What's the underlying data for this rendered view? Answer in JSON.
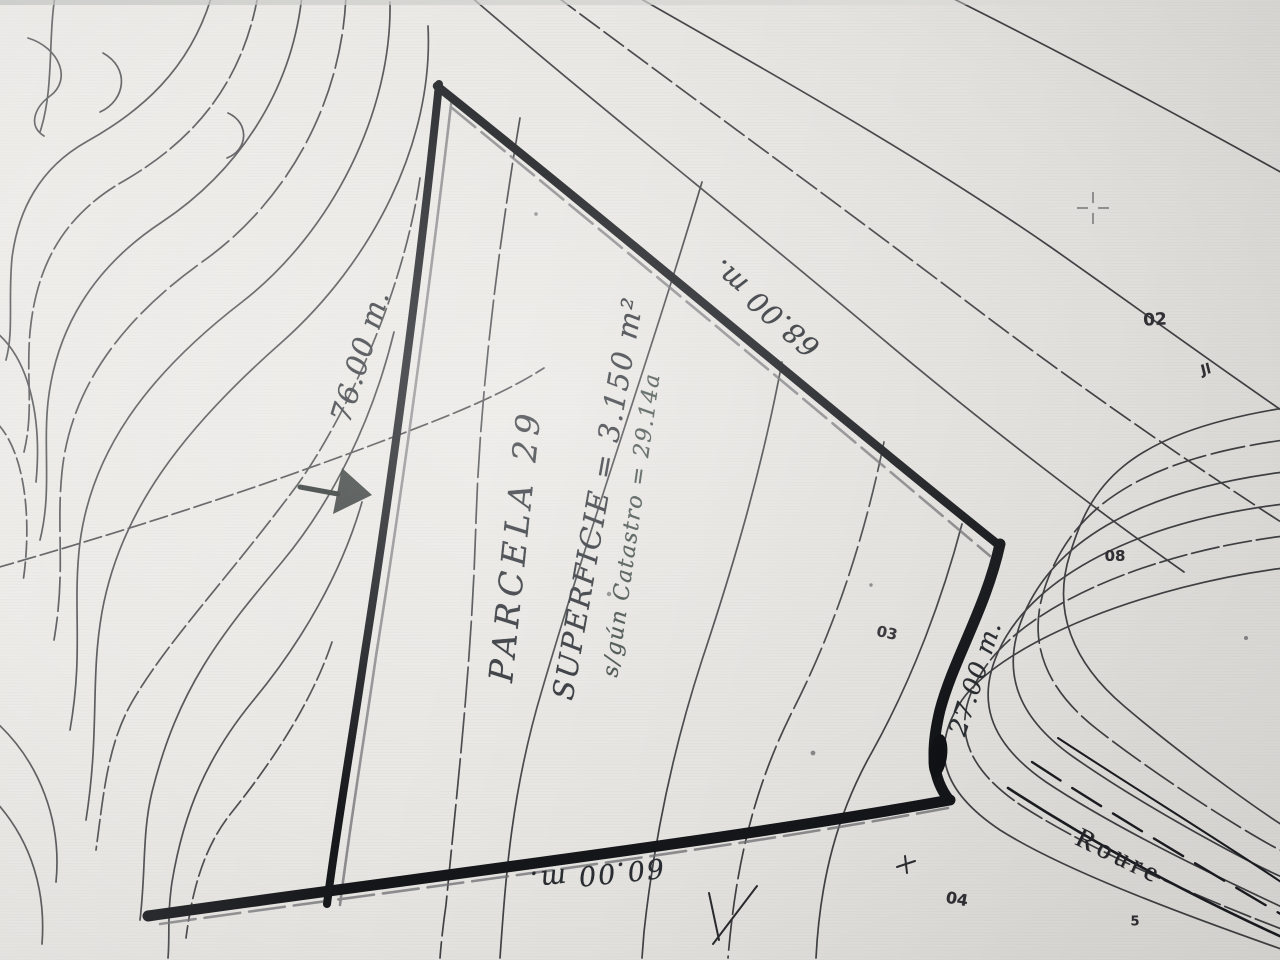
{
  "colors": {
    "paper": "#e9e7e3",
    "ink": "#1e2025",
    "hand_ink": "#2a2e33",
    "soft_ink": "#3f4a46",
    "ghost": "#85868a"
  },
  "parcel": {
    "name": "PARCELA 29",
    "area": "SUPERFICIE = 3.150 m²",
    "cadastre_area": "s/gún Catastro = 29.14a",
    "dimensions": {
      "left": "76.00 m.",
      "right": "68.00 m.",
      "curve": "27.00 m.",
      "bottom": "60.00 m."
    }
  },
  "road": {
    "name": "Roure"
  },
  "plot_numbers": {
    "n02": "02",
    "n08": "08",
    "n03": "03",
    "n04": "04",
    "n5": "5"
  },
  "marks": {
    "jl": "Jl"
  }
}
